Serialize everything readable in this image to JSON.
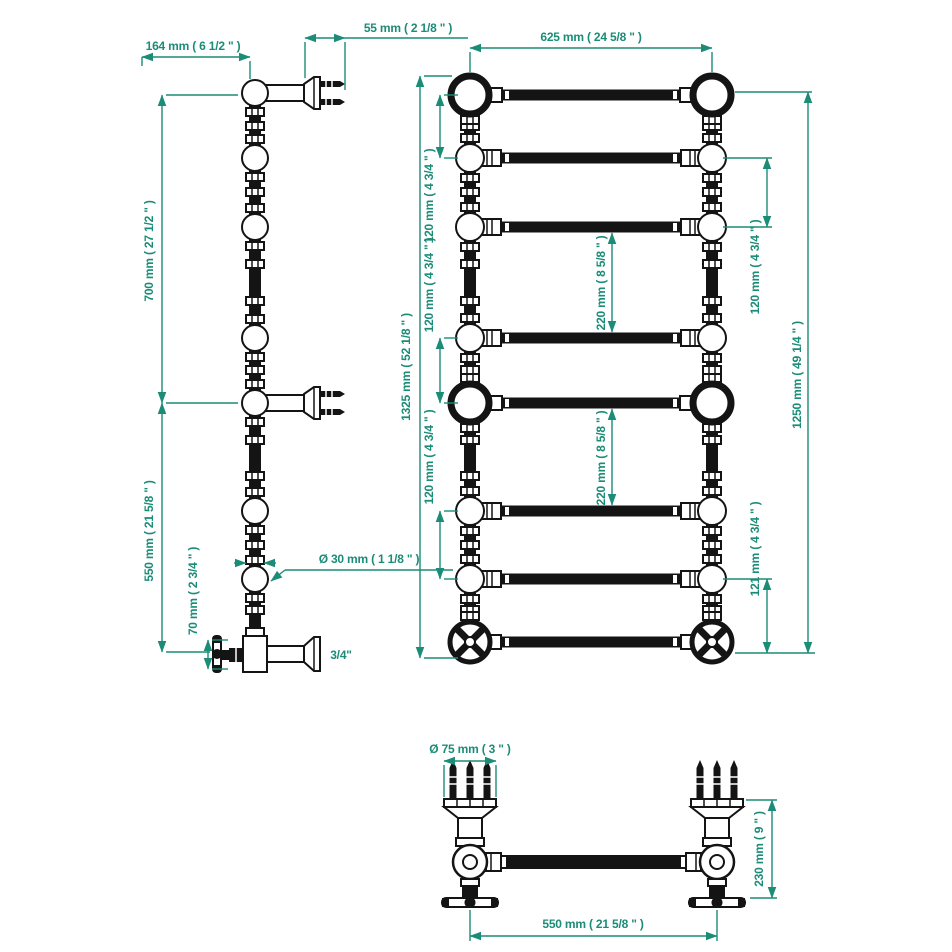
{
  "title": "Heated towel rail dimensional drawing",
  "colors": {
    "dimension": "#1b8c77",
    "linework": "#141414",
    "background": "#ffffff"
  },
  "dimensions": {
    "side_view": {
      "bracket_projection": "164 mm ( 6 1/2 \" )",
      "wall_fixing_length": "55 mm ( 2 1/8 \" )",
      "upper_bracket_spacing": "700 mm ( 27 1/2 \" )",
      "lower_bracket_spacing": "550 mm ( 21 5/8 \" )",
      "tube_diameter": "Ø 30 mm ( 1 1/8 \" )",
      "valve_drop": "70 mm ( 2 3/4 \" )",
      "connection_thread": "3/4\""
    },
    "front_view": {
      "overall_width": "625 mm ( 24 5/8 \" )",
      "overall_height": "1325 mm ( 52 1/8 \" )",
      "rail_height": "1250 mm ( 49 1/4 \" )",
      "gap_120_1": "120 mm ( 4 3/4 \" )",
      "gap_120_2": "120 mm ( 4 3/4 \" )",
      "gap_120_3": "120 mm ( 4 3/4 \" )",
      "gap_120_4": "120 mm ( 4 3/4 \" )",
      "gap_220_1": "220 mm ( 8 5/8 \" )",
      "gap_220_2": "220 mm ( 8 5/8 \" )",
      "gap_121": "121 mm ( 4 3/4 \" )"
    },
    "plan_view": {
      "flange_diameter": "Ø 75 mm ( 3 \" )",
      "wall_to_front": "230 mm ( 9 \" )",
      "fixing_centres": "550 mm ( 21 5/8 \" )"
    }
  }
}
